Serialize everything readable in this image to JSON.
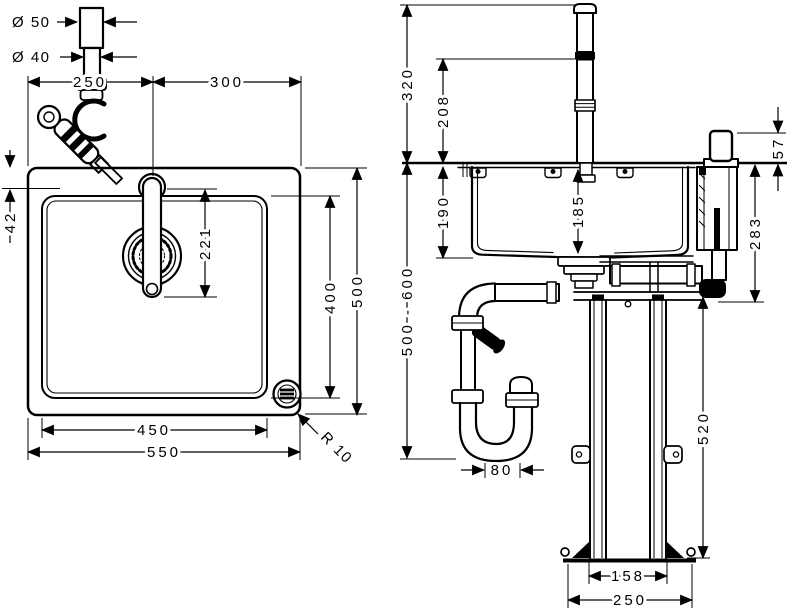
{
  "colors": {
    "line": "#000000",
    "background": "#ffffff"
  },
  "plan": {
    "dia_upper": "Ø 50",
    "dia_lower": "Ø 40",
    "left_to_tap": "250",
    "tap_to_right": "300",
    "edge_to_tap": "42",
    "tap_to_spout": "221",
    "bowl_width": "450",
    "total_width": "550",
    "bowl_depth": "400",
    "total_depth": "500",
    "corner_radius": "R 10"
  },
  "elev": {
    "spout_height": "320",
    "outlet_height": "208",
    "handle_height": "57",
    "bowl_outer_depth": "190",
    "bowl_inner_depth": "185",
    "unit_depth": "283",
    "drain_range": "500 - 600",
    "trap_offset": "80",
    "frame_height": "520",
    "frame_width": "158",
    "base_width": "250"
  }
}
